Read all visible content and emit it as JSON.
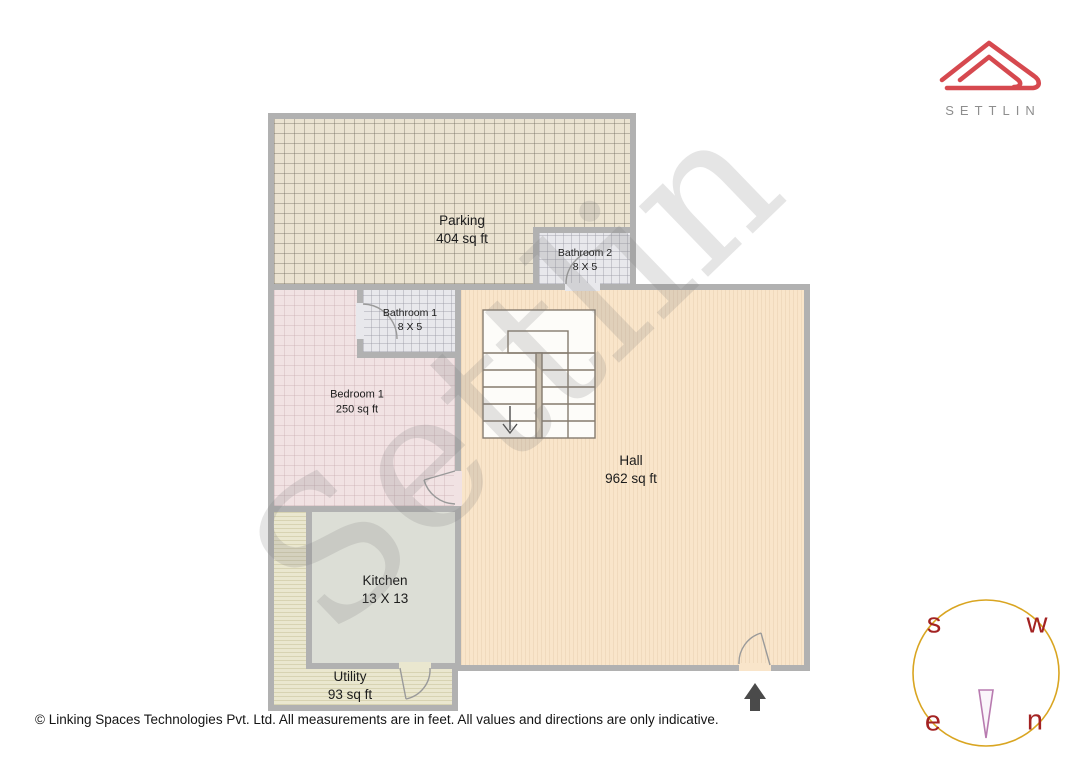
{
  "brand": {
    "name": "SETTLIN",
    "logo_color": "#d6494f"
  },
  "watermark_text": "Settlin",
  "rooms": {
    "parking": {
      "name": "Parking",
      "dims": "404 sq ft"
    },
    "bathroom2": {
      "name": "Bathroom 2",
      "dims": "8 X 5"
    },
    "bathroom1": {
      "name": "Bathroom 1",
      "dims": "8 X 5"
    },
    "bedroom1": {
      "name": "Bedroom 1",
      "dims": "250 sq ft"
    },
    "hall": {
      "name": "Hall",
      "dims": "962 sq ft"
    },
    "kitchen": {
      "name": "Kitchen",
      "dims": "13 X 13"
    },
    "utility": {
      "name": "Utility",
      "dims": "93 sq ft"
    }
  },
  "compass": {
    "top_left": "s",
    "top_right": "w",
    "bottom_left": "e",
    "bottom_right": "n",
    "circle_color": "#d9a521",
    "letter_color": "#a32222",
    "needle_color": "#b87bb0"
  },
  "footer": {
    "text": "© Linking Spaces Technologies Pvt. Ltd. All measurements are in feet. All values and directions are only indicative."
  }
}
